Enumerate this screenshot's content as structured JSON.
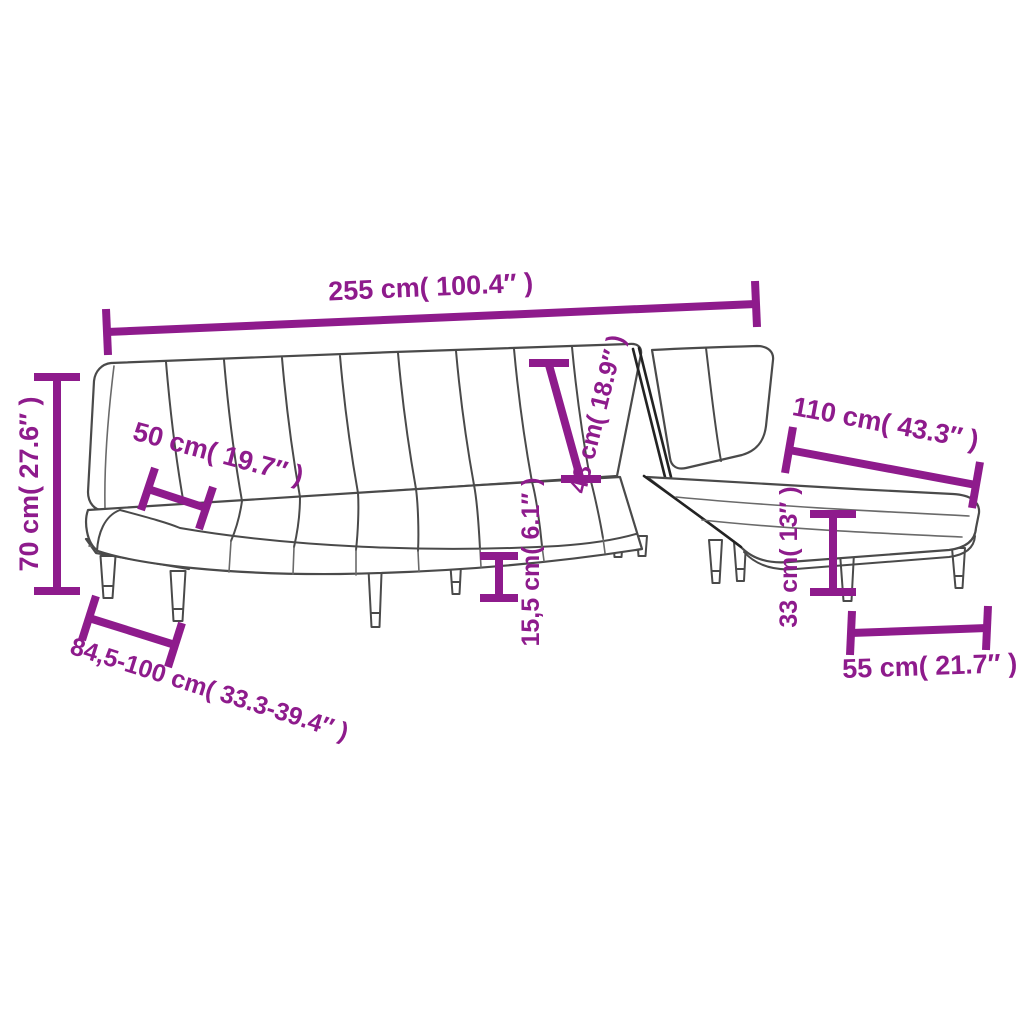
{
  "diagram": {
    "subject": "L-shaped sofa bed with chaise - dimension drawing",
    "background_color": "#FFFFFF",
    "outline_color": "#4A4A4A",
    "accent_color": "#8E1B8C",
    "dimensions": {
      "overall_width_label": "255 cm( 100.4″ )",
      "overall_height_label": "70 cm( 27.6″ )",
      "seat_depth_label": "50 cm( 19.7″ )",
      "backrest_height_label": "48 cm( 18.9″ )",
      "chaise_length_label": "110 cm( 43.3″ )",
      "seat_height_label": "15,5 cm( 6.1″ )",
      "chaise_seat_height_label": "33 cm( 13″ )",
      "depth_range_label": "84,5-100 cm( 33.3-39.4″ )",
      "chaise_width_label": "55 cm( 21.7″ )"
    }
  }
}
